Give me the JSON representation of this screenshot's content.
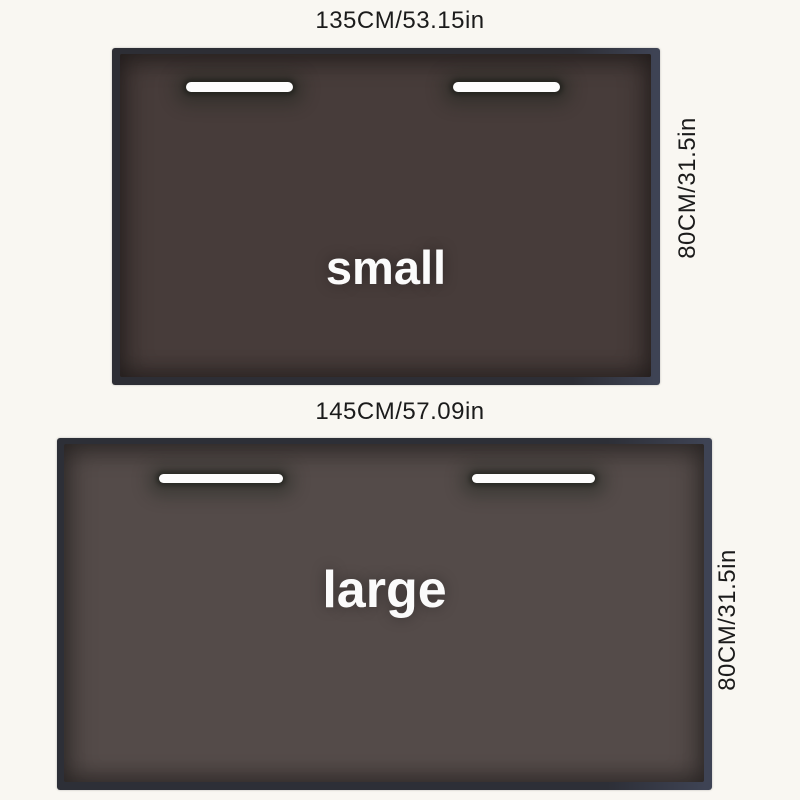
{
  "page": {
    "background_color": "#f9f7f2",
    "label_text_color": "#1b1b1b",
    "slot_color": "#fdfdfd",
    "mat_label_color": "#fbfbfb"
  },
  "mats": [
    {
      "name": "small",
      "label": "small",
      "top_dimension": "135CM/53.15in",
      "side_dimension": "80CM/31.5in",
      "surface_color": "#473c3a",
      "edge_color": "#2d2e35"
    },
    {
      "name": "large",
      "label": "large",
      "top_dimension": "145CM/57.09in",
      "side_dimension": "80CM/31.5in",
      "surface_color": "#544b49",
      "edge_color": "#2d2f37"
    }
  ]
}
